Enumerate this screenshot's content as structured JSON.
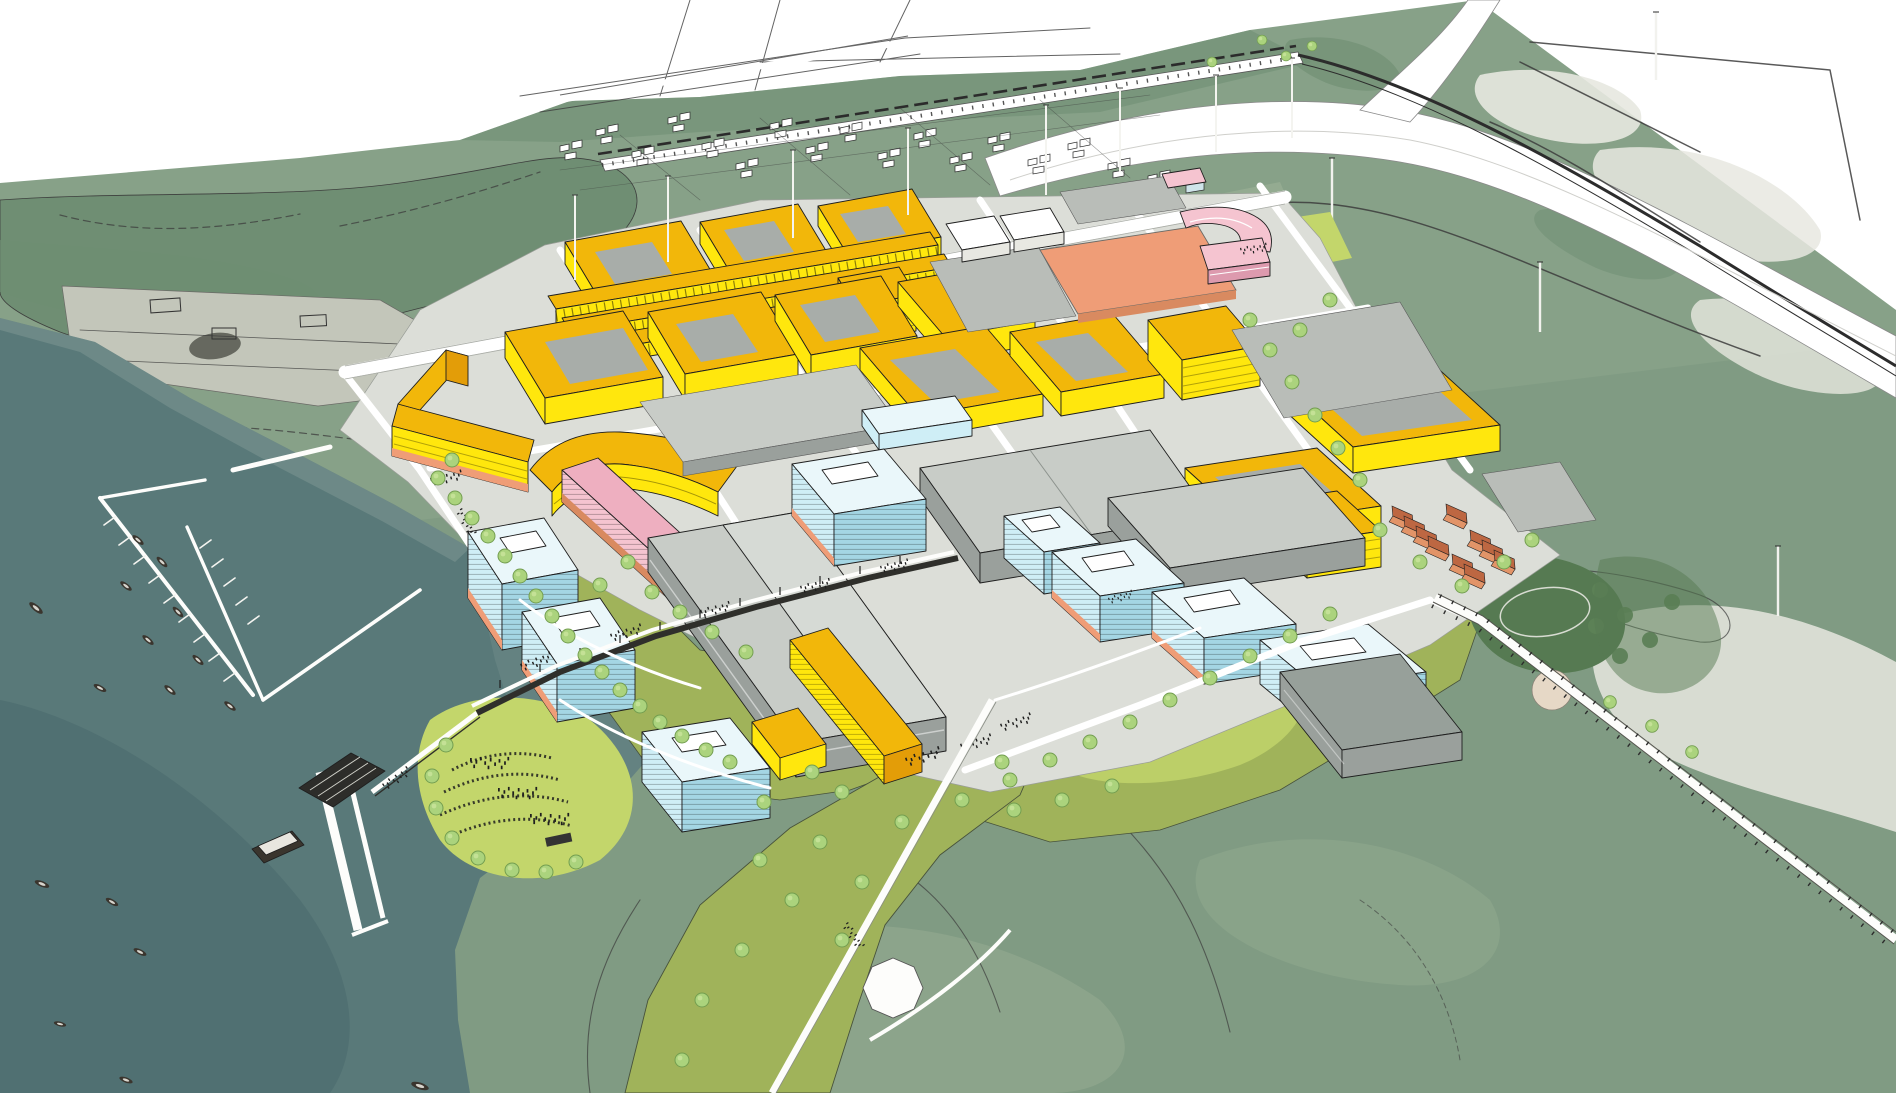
{
  "scene": {
    "label": "Aerial perspective rendering of a waterfront urban masterplan",
    "aria_label": "3D aerial rendering: yellow housing blocks, grey industrial sheds, light-blue office towers, pink and salmon special buildings, green parks, a marina with boats on teal water, a ferry pier, a highway interchange on an aerial photo background"
  },
  "color_legend": {
    "water": "teal harbour water",
    "yFace": "yellow housing blocks",
    "blueFace": "light blue office towers",
    "shedRoof": "grey industrial sheds",
    "pink": "pink special building",
    "salmon": "salmon landmark slab",
    "terraWall": "terracotta row houses",
    "lawn": "designed park lawn",
    "photoGreen": "aerial photo landscape"
  },
  "palette": {
    "bg": "#ffffff",
    "water": "#597979",
    "waterDeep": "#47686b",
    "shore": "#7d9894",
    "photoGreen": "#87a188",
    "photoDark": "#6e8e72",
    "photoPale": "#a9b8a4",
    "photoGray": "#c3c6ba",
    "photoWhite": "#e7e8e0",
    "field": "#7f9a83",
    "fieldLight": "#97ae94",
    "lawn": "#c3d66b",
    "lawnOlive": "#a0b35a",
    "parkDark": "#567a52",
    "tree": "#abd37d",
    "treeEdge": "#739e50",
    "plazaLight": "#dcded8",
    "plazaMid": "#b9bdb8",
    "road": "#ffffff",
    "line": "#3c3c3c",
    "ink": "#1f1f1f",
    "yRoof": "#f2b70a",
    "yFace": "#ffe70d",
    "ySide": "#e39d08",
    "court": "#a8ada9",
    "salmon": "#ef9d77",
    "salmonDk": "#d98a60",
    "pink": "#f5c4d0",
    "pinkRoof": "#eeafc0",
    "pinkSide": "#dd9aae",
    "blueFace": "#cfeef6",
    "blueSide": "#a4d6e4",
    "blueTop": "#eaf7fa",
    "shedRoof": "#c8ccc7",
    "shedRoofDk": "#97a09a",
    "shedWall": "#9aa09c",
    "terraWall": "#e29468",
    "terraRoof": "#bd6742",
    "pier": "#2d2d2a",
    "boat": "#3a352e"
  }
}
